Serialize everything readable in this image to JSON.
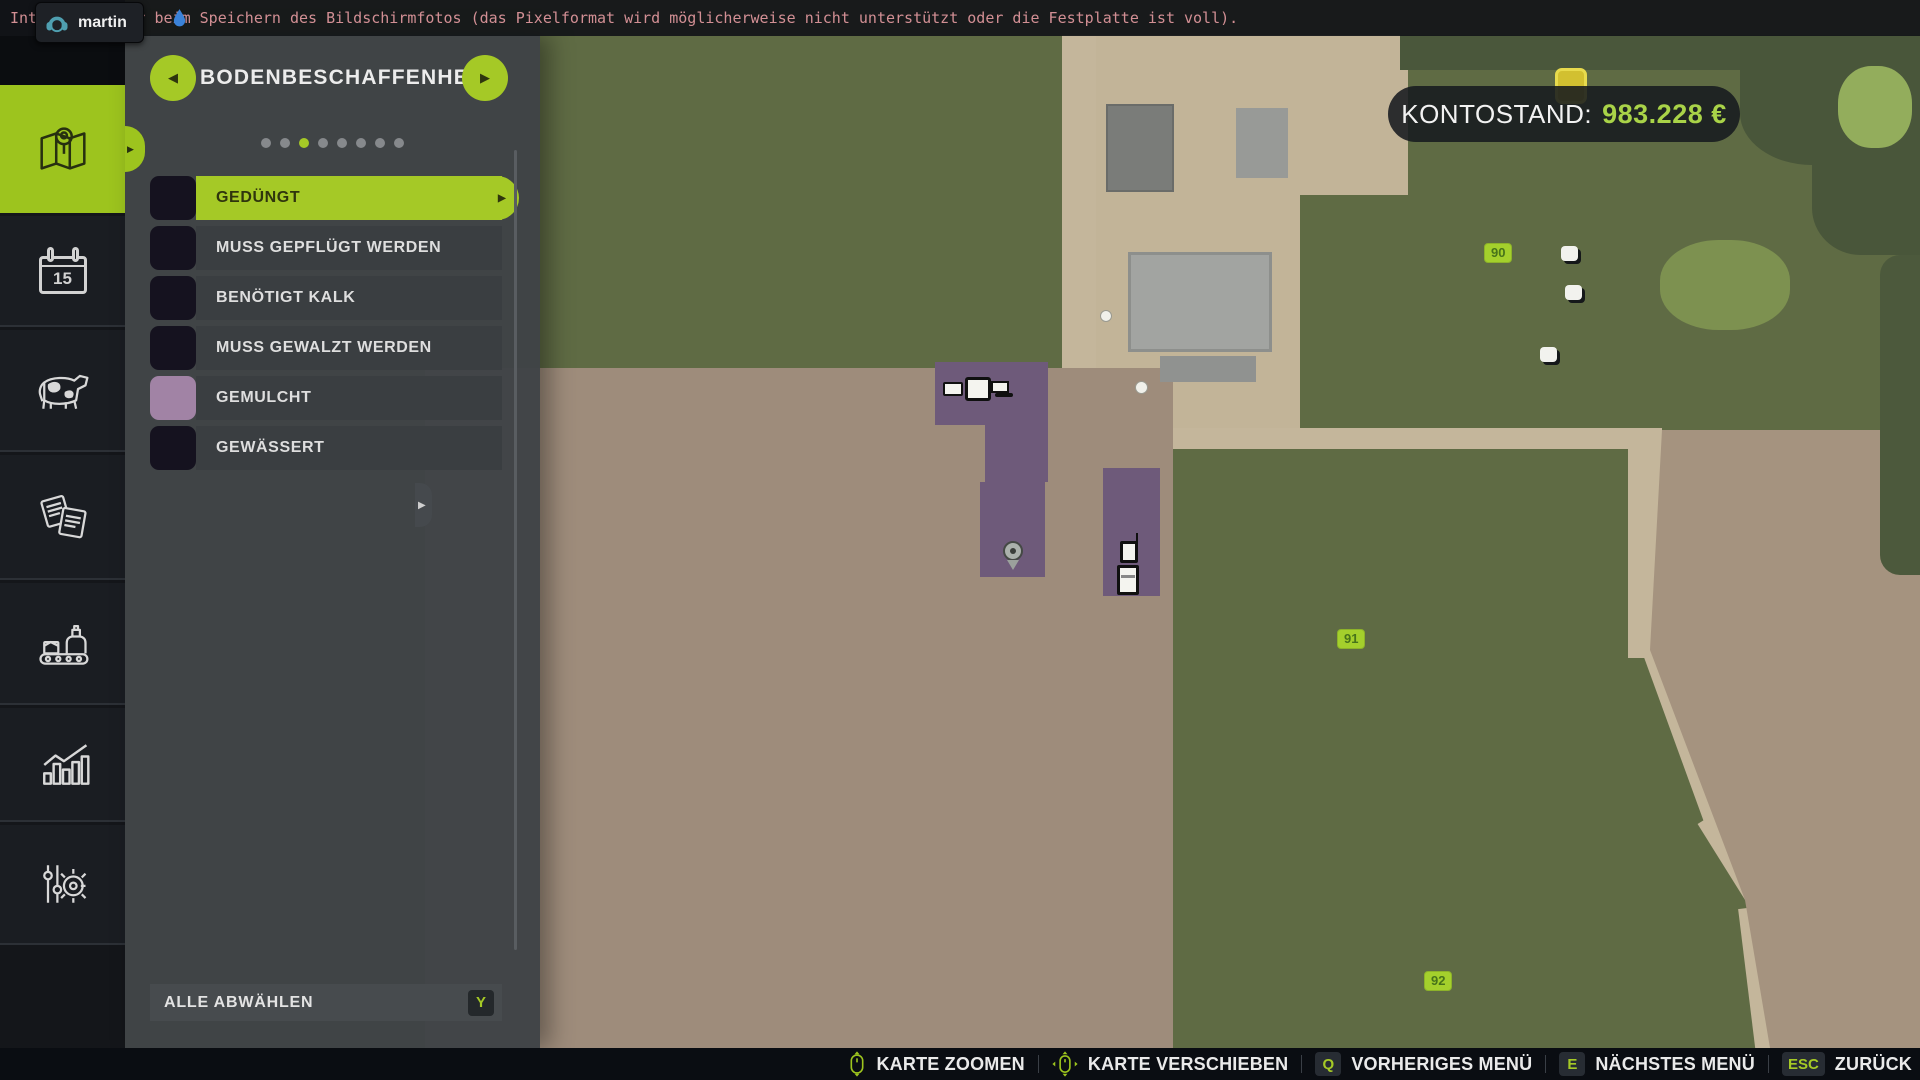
{
  "top_bar": {
    "error_message": "Interner Fehler beim Speichern des Bildschirmfotos (das Pixelformat wird möglicherweise nicht unterstützt oder die Festplatte ist voll).",
    "player_name": "martin"
  },
  "sidebar": {
    "tabs": [
      {
        "id": "map",
        "icon": "map-icon",
        "active": true
      },
      {
        "id": "calendar",
        "icon": "calendar-icon",
        "day": "15",
        "active": false
      },
      {
        "id": "animals",
        "icon": "cow-icon",
        "active": false
      },
      {
        "id": "contracts",
        "icon": "documents-icon",
        "active": false
      },
      {
        "id": "production",
        "icon": "production-icon",
        "active": false
      },
      {
        "id": "statistics",
        "icon": "chart-icon",
        "active": false
      },
      {
        "id": "settings",
        "icon": "sliders-gear-icon",
        "active": false
      }
    ]
  },
  "panel": {
    "title": "BODENBESCHAFFENHEIT",
    "pagination": {
      "total": 8,
      "active": 3
    },
    "items": [
      {
        "label": "GEDÜNGT",
        "swatch": "#15121f",
        "selected": true
      },
      {
        "label": "MUSS GEPFLÜGT WERDEN",
        "swatch": "#15121f",
        "selected": false
      },
      {
        "label": "BENÖTIGT KALK",
        "swatch": "#15121f",
        "selected": false
      },
      {
        "label": "MUSS GEWALZT WERDEN",
        "swatch": "#15121f",
        "selected": false
      },
      {
        "label": "GEMULCHT",
        "swatch": "#a183a5",
        "selected": false
      },
      {
        "label": "GEWÄSSERT",
        "swatch": "#15121f",
        "selected": false
      }
    ],
    "deselect_all_label": "ALLE ABWÄHLEN",
    "deselect_all_key": "Y"
  },
  "hud": {
    "balance_label": "KONTOSTAND:",
    "balance_value": "983.228 €",
    "accent_green": "#a5c926"
  },
  "map": {
    "field_labels": [
      {
        "number": "90"
      },
      {
        "number": "91"
      },
      {
        "number": "92"
      }
    ]
  },
  "bottom_bar": {
    "actions": [
      {
        "icon": "mouse-zoom-icon",
        "label": "KARTE ZOOMEN"
      },
      {
        "icon": "mouse-move-icon",
        "label": "KARTE VERSCHIEBEN"
      },
      {
        "key": "Q",
        "label": "VORHERIGES MENÜ"
      },
      {
        "key": "E",
        "label": "NÄCHSTES MENÜ"
      },
      {
        "key": "ESC",
        "label": "ZURÜCK"
      }
    ]
  }
}
